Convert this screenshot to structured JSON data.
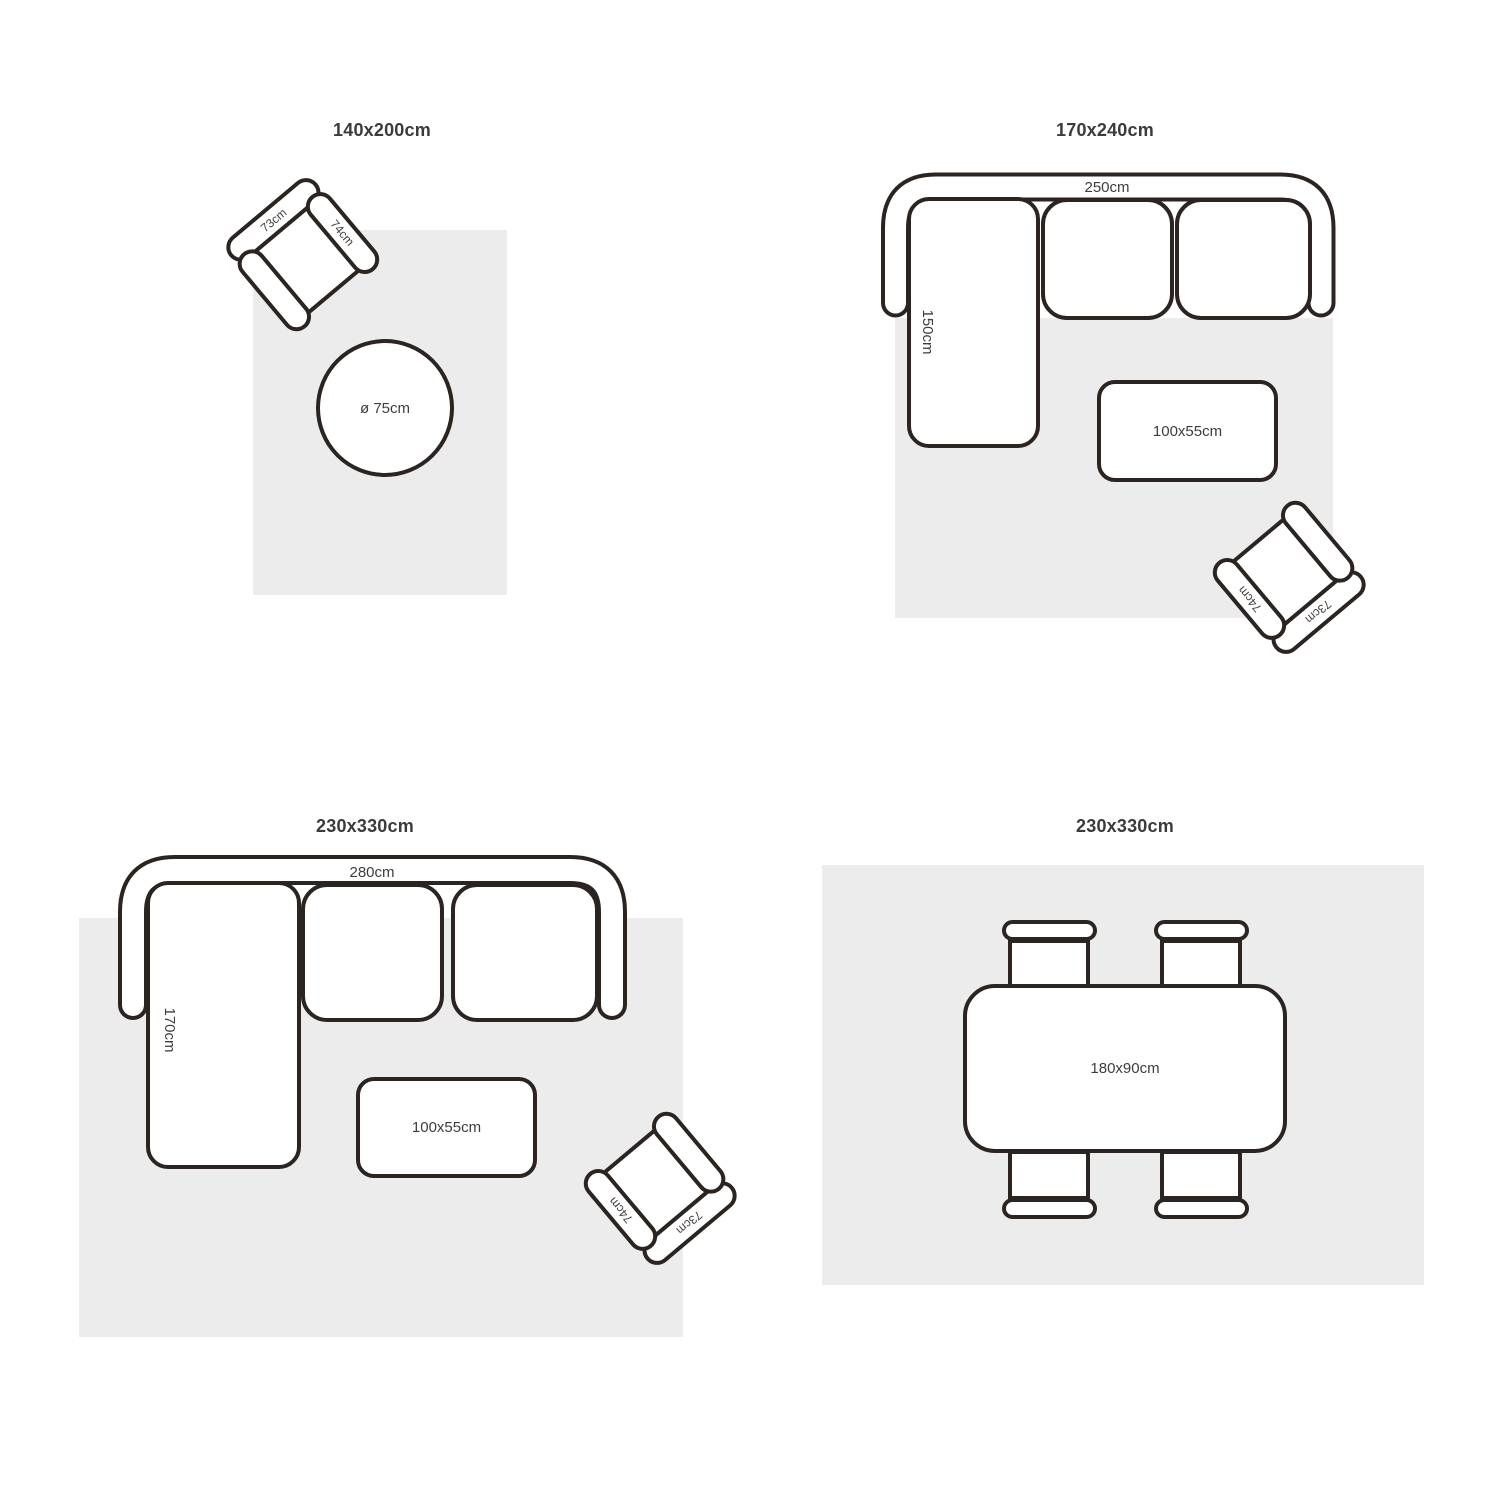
{
  "page": {
    "line_color": "#2b2420",
    "rug_color": "#ececec",
    "title_color": "#3b3b3b",
    "label_color": "#3f3d3b"
  },
  "panels": [
    {
      "id": "top-left",
      "title": "140x200cm",
      "armchair": {
        "back_label": "73cm",
        "side_label": "74cm"
      },
      "round_table": {
        "label": "ø 75cm"
      }
    },
    {
      "id": "top-right",
      "title": "170x240cm",
      "sofa": {
        "width_label": "250cm",
        "depth_label": "150cm"
      },
      "coffee_table": {
        "label": "100x55cm"
      },
      "armchair": {
        "back_label": "73cm",
        "side_label": "74cm"
      }
    },
    {
      "id": "bottom-left",
      "title": "230x330cm",
      "sofa": {
        "width_label": "280cm",
        "depth_label": "170cm"
      },
      "coffee_table": {
        "label": "100x55cm"
      },
      "armchair": {
        "back_label": "73cm",
        "side_label": "74cm"
      }
    },
    {
      "id": "bottom-right",
      "title": "230x330cm",
      "dining_table": {
        "label": "180x90cm"
      }
    }
  ]
}
